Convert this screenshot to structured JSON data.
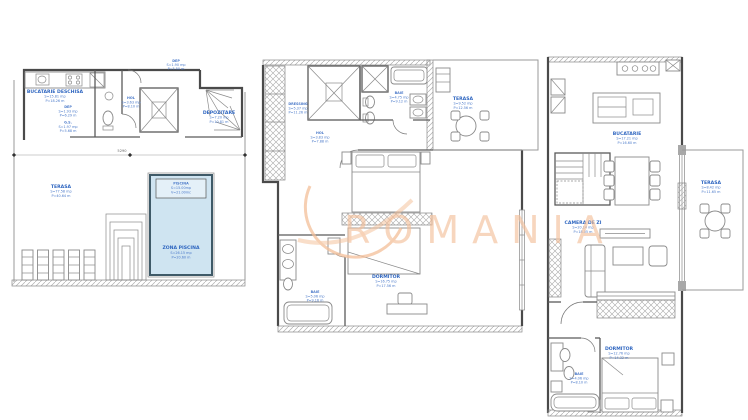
{
  "watermark": {
    "text": "ROMANIA",
    "color": "#f4bf99"
  },
  "colors": {
    "label_blue": "#2f66c0",
    "wall_gray": "#4a4a4a",
    "pool_fill": "#cfe4f1",
    "pool_border": "#3f5a68"
  },
  "plans": {
    "parter": {
      "dep_top": {
        "label": "DEP",
        "area": "S=1.90 mp",
        "perimeter": "P=5.50 m"
      },
      "bucatarie": {
        "label": "BUCATARIE DESCHISA",
        "area": "S=15.81 mp",
        "perimeter": "P=18.26 m"
      },
      "dep": {
        "label": "DEP",
        "area": "S=1.93 mp",
        "perimeter": "P=6.29 m"
      },
      "gs": {
        "label": "G.S.",
        "area": "S=1.97 mp",
        "perimeter": "P=5.68 m"
      },
      "hol": {
        "label": "HOL",
        "area": "S=3.63 mp",
        "perimeter": "P=8.10 m"
      },
      "depozitare": {
        "label": "DEPOZITARE",
        "area": "S=7.20 mp",
        "perimeter": "P=10.81 m"
      },
      "terasa": {
        "label": "TERASA",
        "area": "S=77.58 mp",
        "perimeter": "P=40.64 m"
      },
      "piscina": {
        "label": "PISCINA",
        "line2": "S=15.00mp",
        "line3": "V=21.00mc"
      },
      "zona_piscina": {
        "label": "ZONA PISCINA",
        "area": "S=26.15 mp",
        "perimeter": "P=20.60 m"
      },
      "dim_width": "5290"
    },
    "etaj1": {
      "dressing": {
        "label": "DRESSING",
        "area": "S=5.37 mp",
        "perimeter": "P=11.26 m"
      },
      "hol": {
        "label": "HOL",
        "area": "S=3.83 mp",
        "perimeter": "P=7.88 m"
      },
      "baie1": {
        "label": "BAIE",
        "area": "S=4.75 mp",
        "perimeter": "P=9.12 m"
      },
      "terasa": {
        "label": "TERASA",
        "area": "S=9.52 mp",
        "perimeter": "P=12.56 m"
      },
      "dormitor": {
        "label": "DORMITOR",
        "area": "S=16.75 mp",
        "perimeter": "P=17.56 m"
      },
      "baie2": {
        "label": "BAIE",
        "area": "S=5.06 mp",
        "perimeter": "P=9.16 m"
      }
    },
    "etaj2": {
      "bucatarie": {
        "label": "BUCATARIE",
        "area": "S=17.21 mp",
        "perimeter": "P=16.60 m"
      },
      "terasa": {
        "label": "TERASA",
        "area": "S=8.42 mp",
        "perimeter": "P=11.65 m"
      },
      "camera_zi": {
        "label": "CAMERA DE ZI",
        "area": "S=20.14 mp",
        "perimeter": "P=18.05 m"
      },
      "dormitor": {
        "label": "DORMITOR",
        "area": "S=12.76 mp",
        "perimeter": "P=14.32 m"
      },
      "baie": {
        "label": "BAIE",
        "area": "S=4.06 mp",
        "perimeter": "P=8.10 m"
      }
    }
  }
}
